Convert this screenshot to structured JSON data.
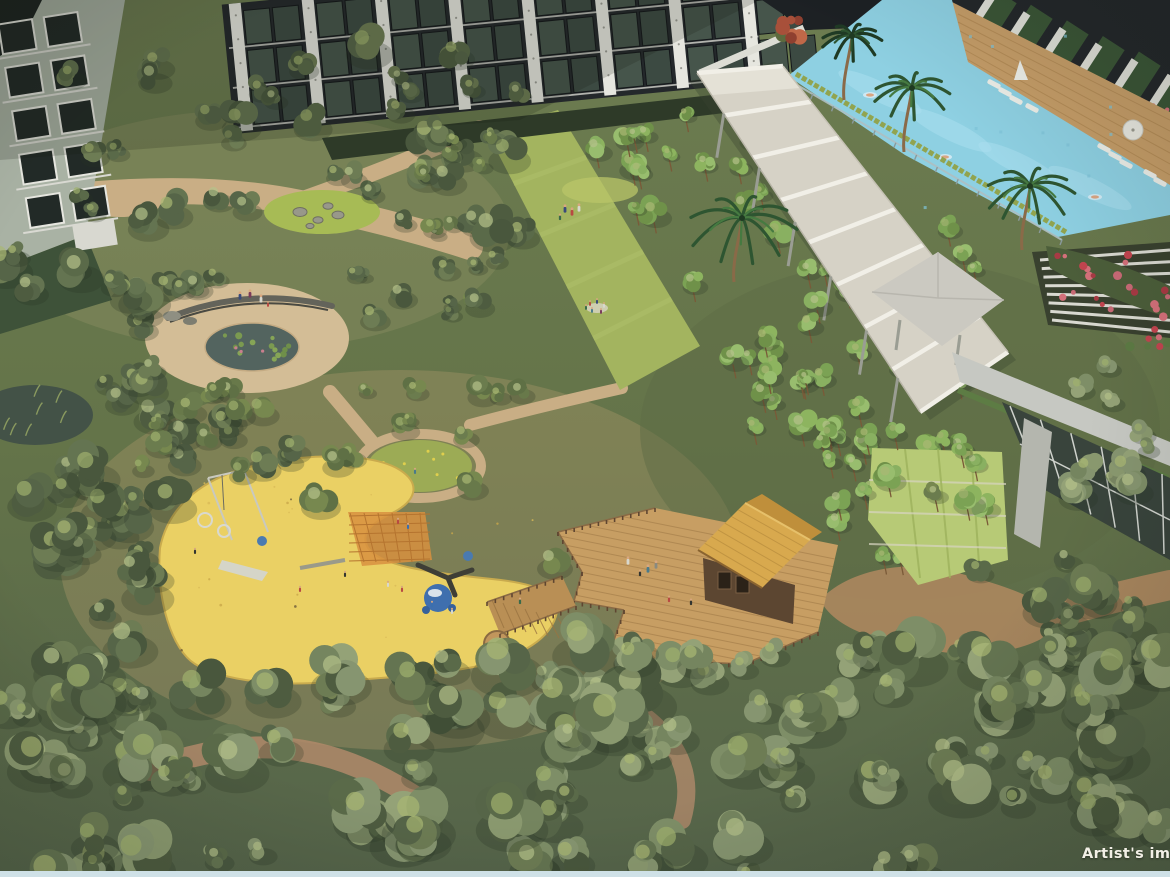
{
  "meta": {
    "type": "aerial-architectural-rendering",
    "subject": "Condominium landscape garden viewed from above"
  },
  "caption": {
    "text": "Artist's imp",
    "color": "#f2efe6"
  },
  "landmarks": [
    "residential tower facades",
    "elevated lap pool",
    "pool deck with sun loungers and umbrellas",
    "covered walkway pergola",
    "clubhouse with glass wall and louvered terrace",
    "slender-tree forest grove",
    "central picnic lawn",
    "lily pond plaza with curved bench",
    "rain garden with rocks",
    "sand playground with play equipment",
    "timber deck with thatched-roof pavilion",
    "woodland paths and dense tree canopy"
  ],
  "palette": {
    "foliage_dark": "#4e5c40",
    "foliage_sage": "#8a996f",
    "foliage_bright": "#89b061",
    "sand_playground": "#ead064",
    "path_tan": "#c9ae85",
    "pool_water": "#8ed0e2",
    "pool_deck_wood": "#c59d68",
    "pergola": "#d6d2c6",
    "deck_wood": "#c79e63",
    "thatch_roof": "#d2a452",
    "building_dark": "#23272a",
    "building_pier": "#e4e4dc",
    "flowers_red": "#c2454f",
    "lawn_green": "#a3b45f",
    "pond_water": "#53645f",
    "border_strip": "#cfe1e7"
  }
}
